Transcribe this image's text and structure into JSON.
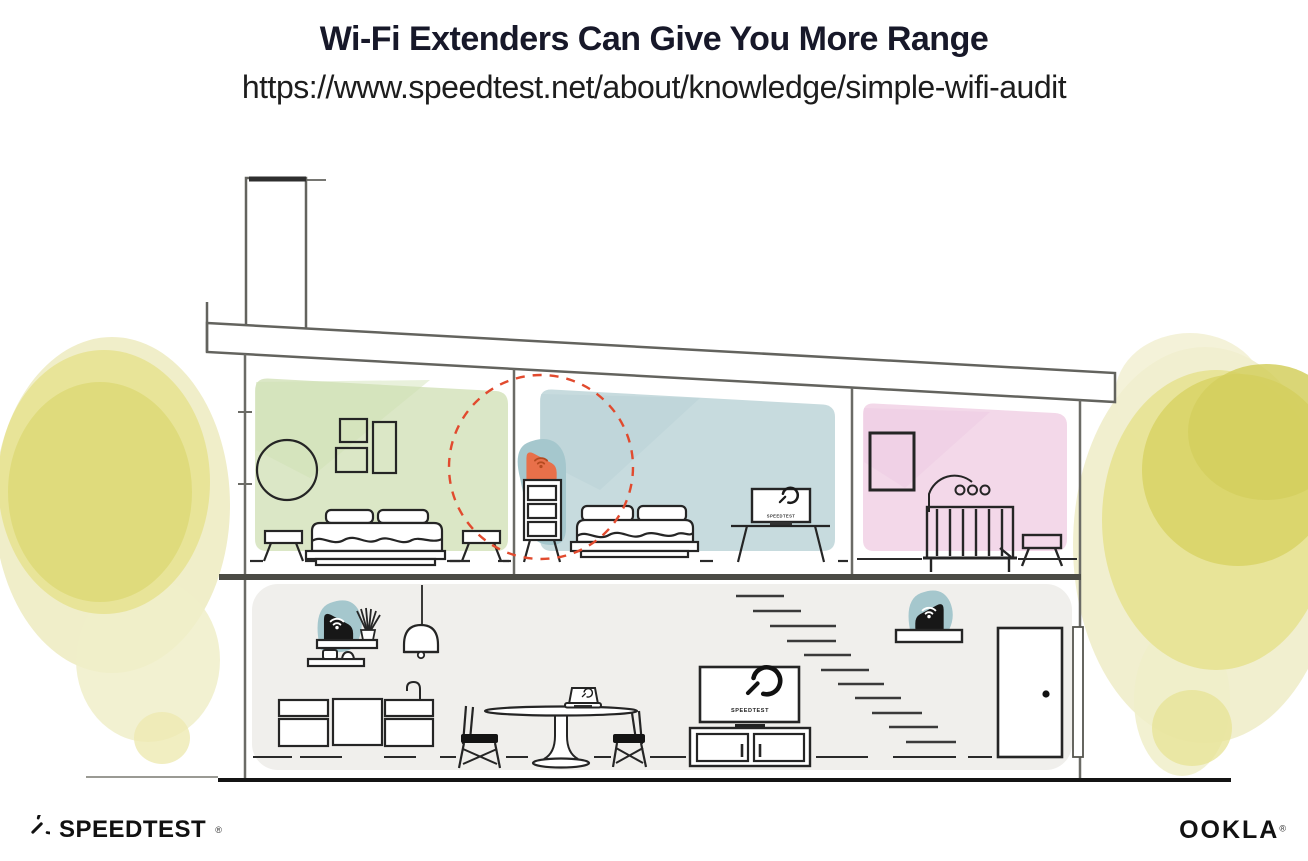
{
  "header": {
    "title": "Wi-Fi Extenders Can Give You More Range",
    "url": "https://www.speedtest.net/about/knowledge/simple-wifi-audit"
  },
  "branding": {
    "speedtest_wordmark": "SPEEDTEST",
    "speedtest_trademark": "®",
    "ookla_wordmark": "OOKLA",
    "ookla_trademark": "®"
  },
  "illustration": {
    "bedroom_tv_label": "SPEEDTEST",
    "living_tv_label": "SPEEDTEST",
    "rooms": [
      "green-bedroom",
      "blue-bedroom",
      "pink-nursery",
      "living-area"
    ],
    "devices": [
      "wifi-extender-on-dresser",
      "wifi-router-on-shelf-left",
      "wifi-extender-on-shelf-right"
    ],
    "colors": {
      "extender_orange": "#e8704a",
      "extender_wifi_dark": "#b44a20",
      "device_teal_halo": "#a5c7cd",
      "range_circle_red": "#e14a2e",
      "room_green": "#dbe7c6",
      "room_blue": "#c7dbde",
      "room_pink": "#f3d8e9",
      "living_gray": "#f0efec",
      "tree_yellow": "#e0dc7a",
      "line_dark": "#222222",
      "wall_gray": "#6b6b66"
    }
  }
}
